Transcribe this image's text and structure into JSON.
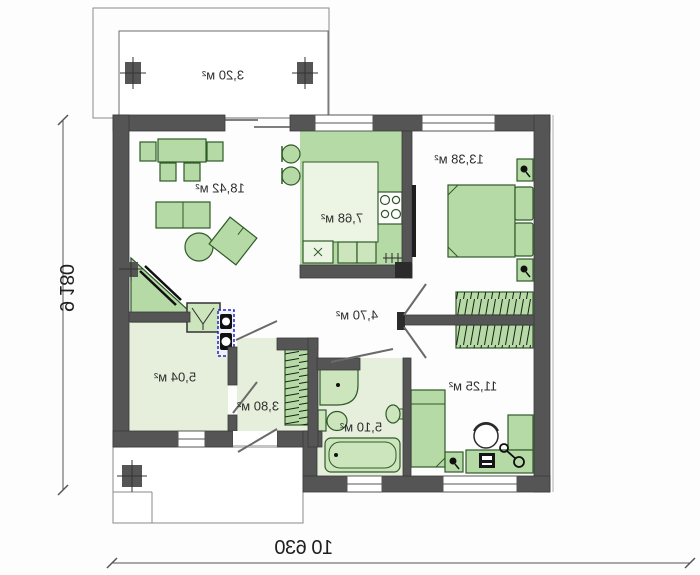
{
  "plan_type": "single-storey house floor plan (mirrored print)",
  "rooms": [
    {
      "name": "terrace",
      "area": "3,20 м²"
    },
    {
      "name": "living-room",
      "area": "18,42 м²"
    },
    {
      "name": "kitchen",
      "area": "7,68 м²"
    },
    {
      "name": "bedroom-1",
      "area": "13,38 м²"
    },
    {
      "name": "hallway",
      "area": "4,70 м²"
    },
    {
      "name": "utility-room",
      "area": "5,04 м²"
    },
    {
      "name": "entrance-hall",
      "area": "3,80 м²"
    },
    {
      "name": "bathroom",
      "area": "5,10 м²"
    },
    {
      "name": "bedroom-2",
      "area": "11,25 м²"
    }
  ],
  "dimensions": {
    "overall_width_mm": "10 630",
    "overall_depth_mm": "9 180"
  },
  "symbols": [
    "fireplace",
    "column",
    "chimney",
    "wardrobe-hatch",
    "table-lamp",
    "desktop-computer",
    "desk-chair",
    "boiler",
    "washbasin",
    "shower",
    "toilet",
    "bathtub",
    "stove",
    "kitchen-sink"
  ],
  "colors": {
    "wall": "#555555",
    "furniture_fill": "#b6daa5",
    "furniture_stroke": "#2f5a28",
    "floor_light": "#e5efdb",
    "fixture_fill": "#cde5bc",
    "kitchen_free_floor": "#ecf4e3",
    "boiler_outline": "#2424c8",
    "dimension_text": "#1f1f1f"
  }
}
